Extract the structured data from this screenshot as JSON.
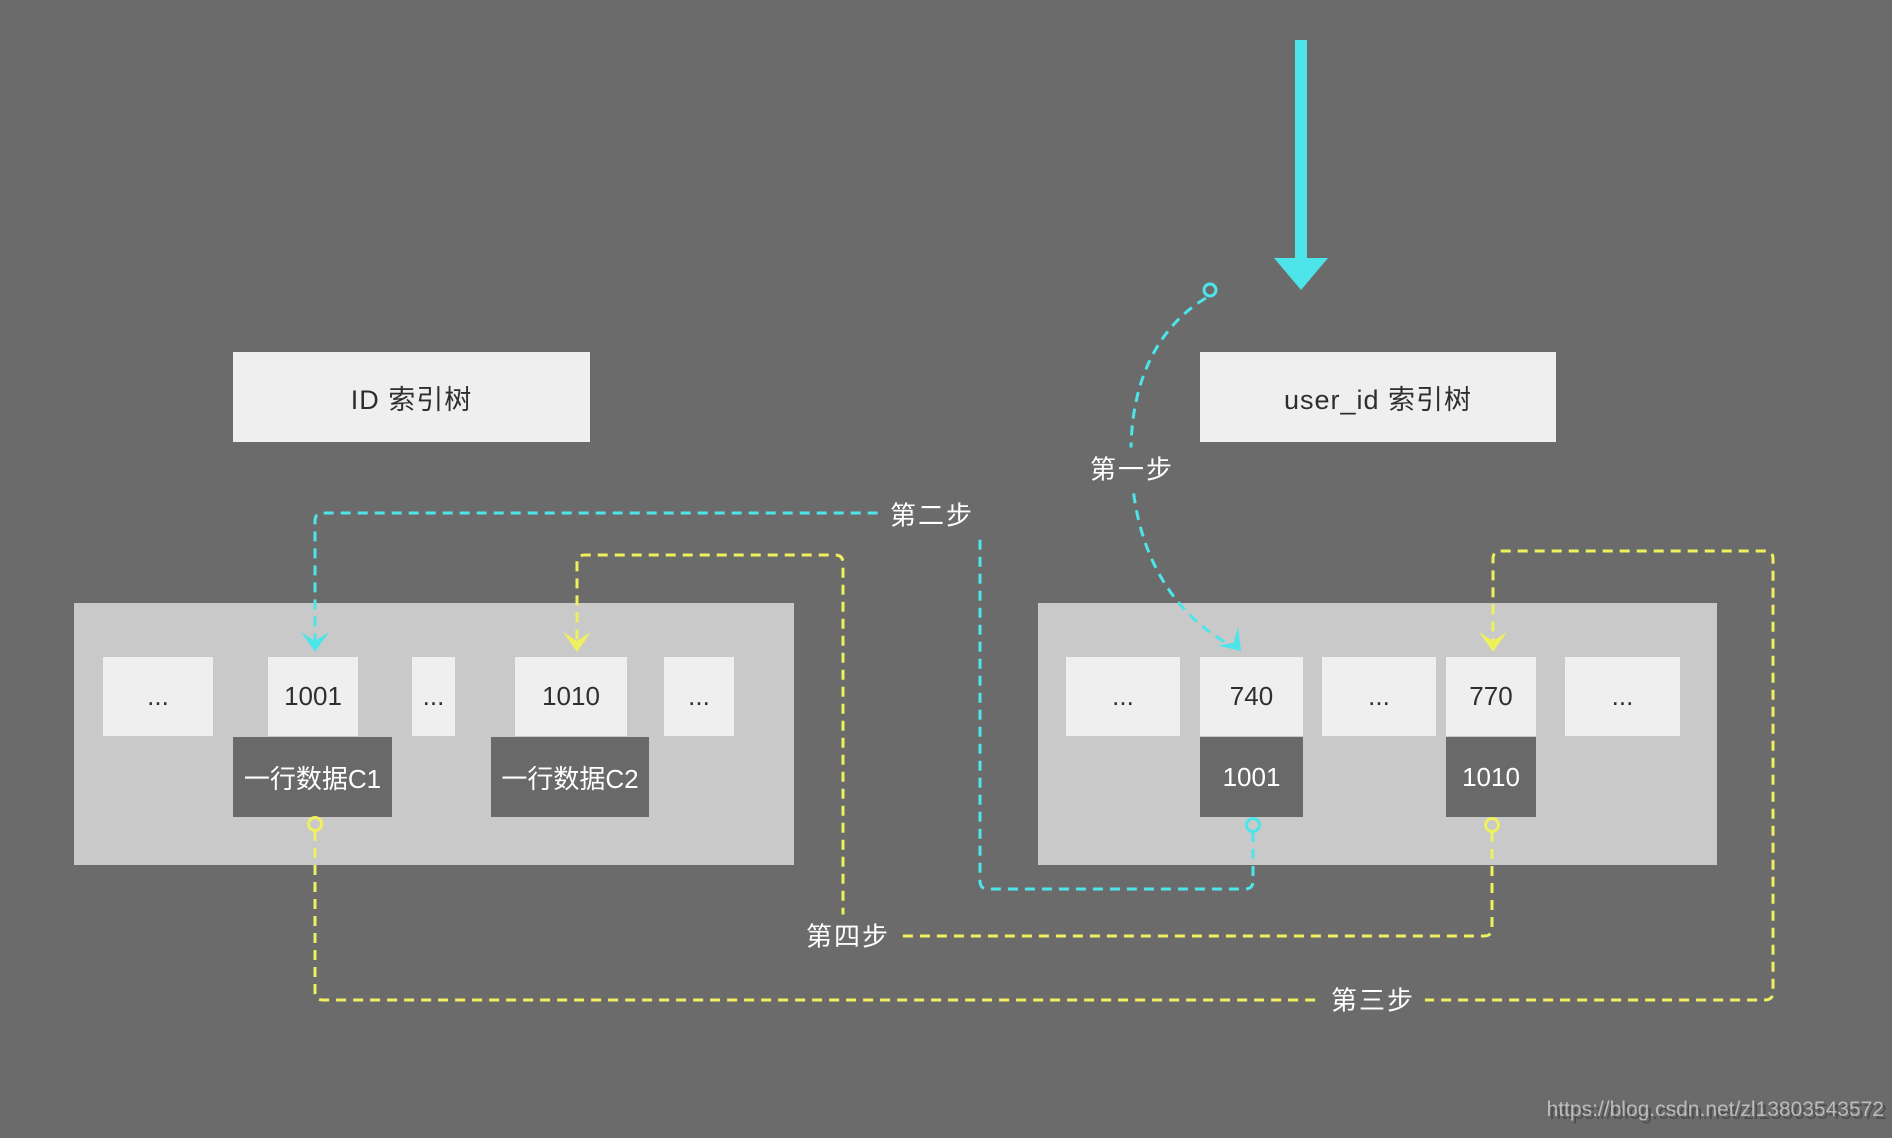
{
  "headers": {
    "left": "ID 索引树",
    "right": "user_id 索引树"
  },
  "left_tree": {
    "cells": [
      {
        "label": "..."
      },
      {
        "label": "1001"
      },
      {
        "label": "..."
      },
      {
        "label": "1010"
      },
      {
        "label": "..."
      }
    ],
    "row_boxes": [
      {
        "label": "一行数据C1"
      },
      {
        "label": "一行数据C2"
      }
    ]
  },
  "right_tree": {
    "cells": [
      {
        "label": "..."
      },
      {
        "label": "740"
      },
      {
        "label": "..."
      },
      {
        "label": "770"
      },
      {
        "label": "..."
      }
    ],
    "key_boxes": [
      {
        "label": "1001"
      },
      {
        "label": "1010"
      }
    ]
  },
  "steps": {
    "step1": {
      "label": "第一步",
      "color": "cyan"
    },
    "step2": {
      "label": "第二步",
      "color": "cyan"
    },
    "step3": {
      "label": "第三步",
      "color": "yellow"
    },
    "step4": {
      "label": "第四步",
      "color": "yellow"
    }
  },
  "colors": {
    "background": "#6b6b6b",
    "container": "#c9c9c9",
    "cell": "#efefef",
    "dark_box": "#696969",
    "cyan_accent": "#4de4ea",
    "yellow_accent": "#eef05e",
    "dark_text": "#2e2e2e",
    "light_text": "#ffffff"
  },
  "watermark": {
    "url": "https://blog.csdn.net/zl13803543572"
  }
}
